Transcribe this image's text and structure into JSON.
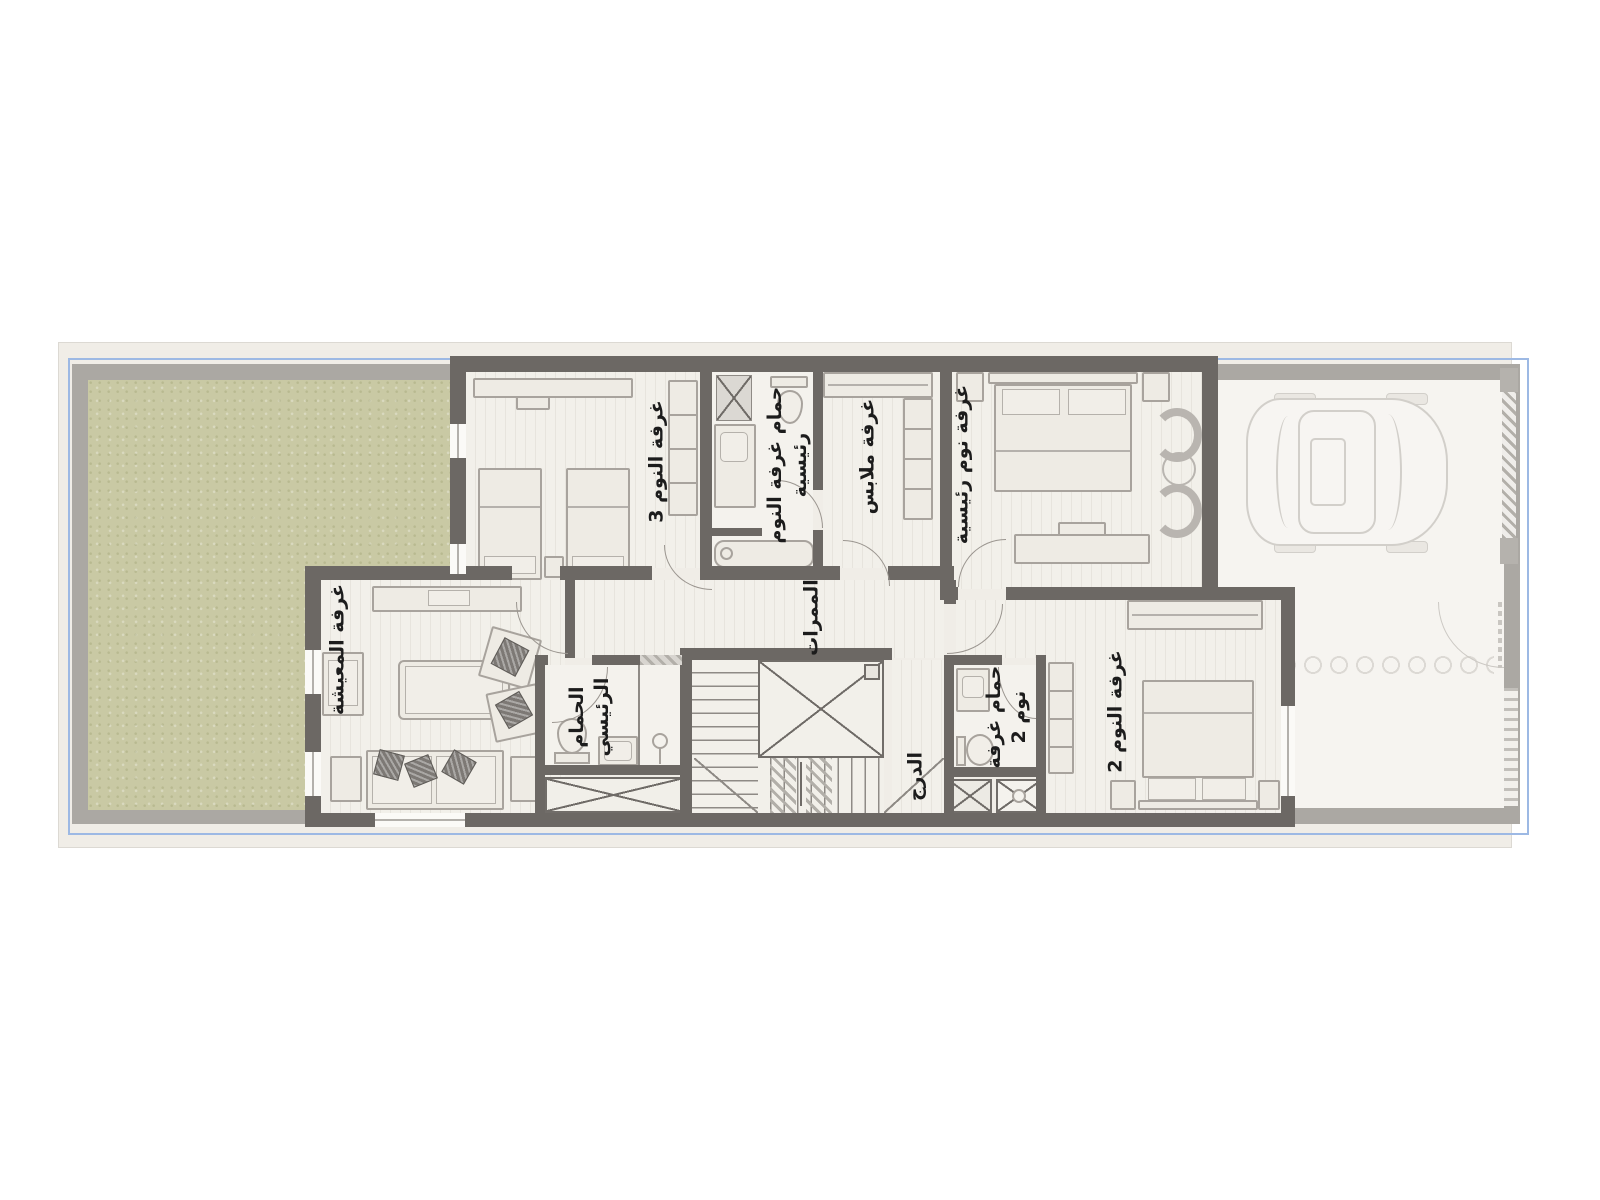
{
  "plan": {
    "type": "residential-villa-first-floor-plan",
    "language": "ar"
  },
  "rooms": {
    "bedroom3": {
      "label": "غرفة النوم 3"
    },
    "master_bath_upper": {
      "label": "حمام غرفة النوم\nرئيسية"
    },
    "dressing": {
      "label": "غرفة ملابس"
    },
    "master_bedroom": {
      "label": "غرفة نوم رئيسية"
    },
    "living": {
      "label": "غرفة المعيشة"
    },
    "corridors": {
      "label": "الممرات"
    },
    "master_bath_lower": {
      "label": "الحمام\nالرئيسي"
    },
    "stairs": {
      "label": "الدرج"
    },
    "bath2": {
      "label": "حمام غرفة\nنوم 2"
    },
    "bedroom2": {
      "label": "غرفة النوم 2"
    }
  },
  "colors": {
    "wall_active": "#6c6864",
    "wall_faded": "#aba8a3",
    "floor": "#f2f0ea",
    "garden": "#c9c9a4",
    "plot_line_blue": "#9db9e4",
    "site_background": "#f0ede7",
    "label_text": "#1c1c1c"
  }
}
